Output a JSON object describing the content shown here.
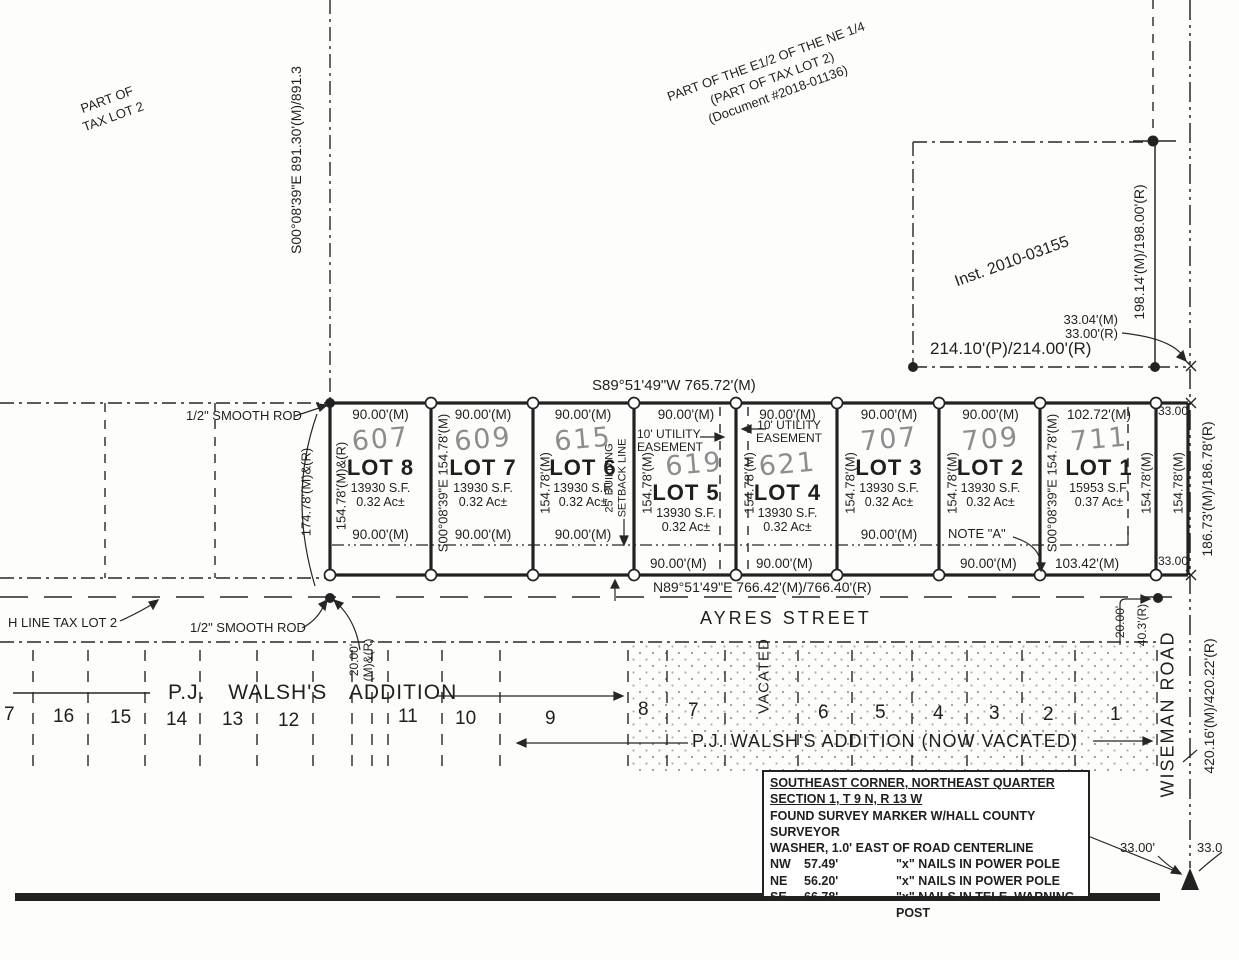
{
  "areas": {
    "tax_lot_2_line1": "PART OF",
    "tax_lot_2_line2": "TAX LOT 2",
    "ne_quarter_line1": "PART OF THE E1/2 OF THE NE 1/4",
    "ne_quarter_line2": "(PART OF TAX LOT 2)",
    "ne_quarter_line3": "(Document #2018-01136)",
    "inst_parcel": "Inst. 2010-03155"
  },
  "dimensions": {
    "west_line": "S00°08'39\"E  891.30'(M)/891.3",
    "north_line": "S89°51'49\"W 765.72'(M)",
    "south_line": "N89°51'49\"E 766.42'(M)/766.40'(R)",
    "east_parcel": "198.14'(M)/198.00'(R)",
    "parcel_south": "214.10'(P)/214.00'(R)",
    "offset_33_m": "33.04'(M)",
    "offset_33_r": "33.00'(R)",
    "strip_top": "33.00'",
    "strip_bottom": "33.00'",
    "strip_side_1": "154.78'(M)",
    "strip_side_2": "154.78'(M)",
    "east_lot_line": "186.73'(M)/186.78'(R)",
    "wiseman_length": "420.16'(M)/420.22'(R)",
    "west_outer": "174.78'(M)&(R)",
    "alley_w_1": "20.00'",
    "alley_w_2": "(M)&(R)",
    "wiseman_offset": "20.00'",
    "wiseman_offset_r": "40.3'(R)",
    "road_33_left": "33.00'",
    "road_33_right": "33.0"
  },
  "streets": {
    "ayres": "AYRES STREET",
    "wiseman": "WISEMAN ROAD"
  },
  "markers": {
    "rod_top": "1/2\" SMOOTH ROD",
    "rod_bottom": "1/2\" SMOOTH ROD",
    "h_line": "H LINE TAX LOT 2",
    "note_a": "NOTE \"A\""
  },
  "easements": {
    "lot5_l1": "10' UTILITY",
    "lot5_l2": "EASEMENT",
    "lot4_l1": "10' UTILITY",
    "lot4_l2": "EASEMENT",
    "setback_l1": "25' BUILDING",
    "setback_l2": "SETBACK LINE"
  },
  "lots": [
    {
      "name": "LOT 8",
      "address": "607",
      "width_top": "90.00'(M)",
      "width_bottom": "90.00'(M)",
      "area_sf": "13930 S.F.",
      "area_ac": "0.32 Ac±",
      "side": "154.78'(M)&(R)"
    },
    {
      "name": "LOT 7",
      "address": "609",
      "width_top": "90.00'(M)",
      "width_bottom": "90.00'(M)",
      "area_sf": "13930 S.F.",
      "area_ac": "0.32 Ac±",
      "side": "S00°08'39\"E 154.78'(M)"
    },
    {
      "name": "LOT 6",
      "address": "615",
      "width_top": "90.00'(M)",
      "width_bottom": "90.00'(M)",
      "area_sf": "13930 S.F.",
      "area_ac": "0.32 Ac±",
      "side": "154.78'(M)"
    },
    {
      "name": "LOT 5",
      "address": "619",
      "width_top": "90.00'(M)",
      "width_bottom": "90.00'(M)",
      "area_sf": "13930 S.F.",
      "area_ac": "0.32 Ac±",
      "side": "154.78'(M)"
    },
    {
      "name": "LOT 4",
      "address": "621",
      "width_top": "90.00'(M)",
      "width_bottom": "90.00'(M)",
      "area_sf": "13930 S.F.",
      "area_ac": "0.32 Ac±",
      "side": "154.78'(M)"
    },
    {
      "name": "LOT 3",
      "address": "707",
      "width_top": "90.00'(M)",
      "width_bottom": "90.00'(M)",
      "area_sf": "13930 S.F.",
      "area_ac": "0.32 Ac±",
      "side": "154.78'(M)"
    },
    {
      "name": "LOT 2",
      "address": "709",
      "width_top": "90.00'(M)",
      "width_bottom": "90.00'(M)",
      "area_sf": "13930 S.F.",
      "area_ac": "0.32 Ac±",
      "side": "154.78'(M)"
    },
    {
      "name": "LOT 1",
      "address": "711",
      "width_top": "102.72'(M)",
      "width_bottom": "103.42'(M)",
      "area_sf": "15953 S.F.",
      "area_ac": "0.37 Ac±",
      "side": "S00°08'39\"E 154.78'(M)"
    }
  ],
  "walsh": {
    "heading": "P.J. WALSH'S ADDITION",
    "vacated_heading": "P.J. WALSH'S ADDITION (NOW VACATED)",
    "vacated_label": "VACATED",
    "lot_numbers": [
      "7",
      "16",
      "15",
      "14",
      "13",
      "12",
      "11",
      "10",
      "9",
      "8",
      "7",
      "6",
      "5",
      "4",
      "3",
      "2",
      "1"
    ]
  },
  "note_box": {
    "line1": "SOUTHEAST CORNER, NORTHEAST QUARTER",
    "line2": "SECTION 1, T 9 N, R 13 W",
    "line3": "FOUND SURVEY MARKER W/HALL COUNTY SURVEYOR",
    "line4": "WASHER, 1.0' EAST OF ROAD CENTERLINE",
    "rows": [
      {
        "dir": "NW",
        "dist": "57.49'",
        "desc": "\"x\" NAILS IN POWER POLE"
      },
      {
        "dir": "NE",
        "dist": "56.20'",
        "desc": "\"x\" NAILS IN POWER POLE"
      },
      {
        "dir": "SE",
        "dist": "66.78'",
        "desc": "\"x\" NAILS IN TELE. WARNING POST"
      }
    ]
  }
}
